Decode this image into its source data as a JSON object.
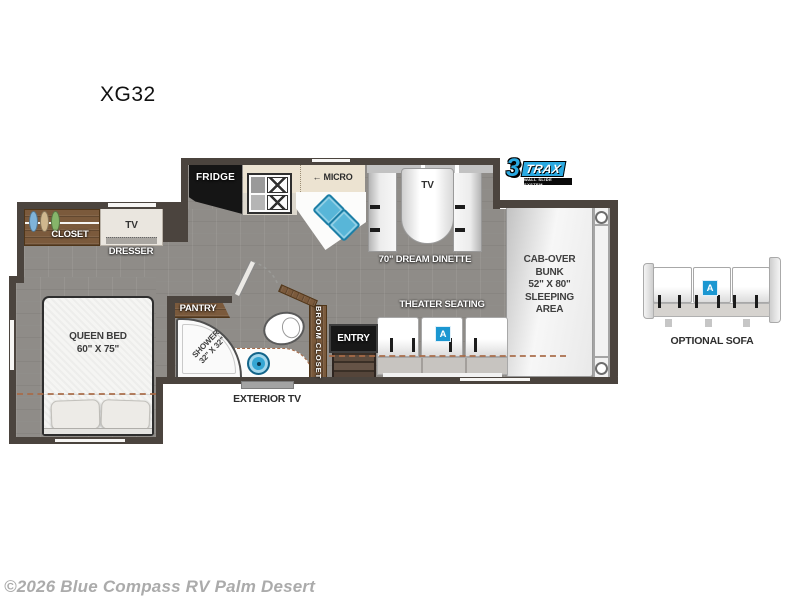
{
  "title": "XG32",
  "watermark": "©2026 Blue Compass RV Palm Desert",
  "logo": {
    "number": "3",
    "word": "TRAX",
    "tagline": "WALL SLIDE SYSTEM"
  },
  "labels": {
    "closet": "CLOSET",
    "dresser": "DRESSER",
    "dresser_tv": "TV",
    "fridge": "FRIDGE",
    "micro": "← MICRO",
    "dinette_tv": "TV",
    "dinette": "70\" DREAM DINETTE",
    "theater": "THEATER SEATING",
    "entry": "ENTRY",
    "broom": "BROOM CLOSET",
    "pantry": "PANTRY",
    "shower1": "SHOWER",
    "shower2": "32\" X 32\"",
    "bed1": "QUEEN BED",
    "bed2": "60\" X 75\"",
    "cab": [
      "CAB-OVER",
      "BUNK",
      "52\" X 80\"",
      "SLEEPING",
      "AREA"
    ],
    "exterior_tv": "EXTERIOR TV",
    "optional_sofa": "OPTIONAL SOFA",
    "option_badge": "A"
  },
  "colors": {
    "accent_blue": "#2aa9e1",
    "badge_blue": "#1b97d1",
    "cushion_blue": "#58b6d8",
    "wood": "#7b5a3c",
    "wall": "#4b443e",
    "floor": "#8f8c88"
  }
}
